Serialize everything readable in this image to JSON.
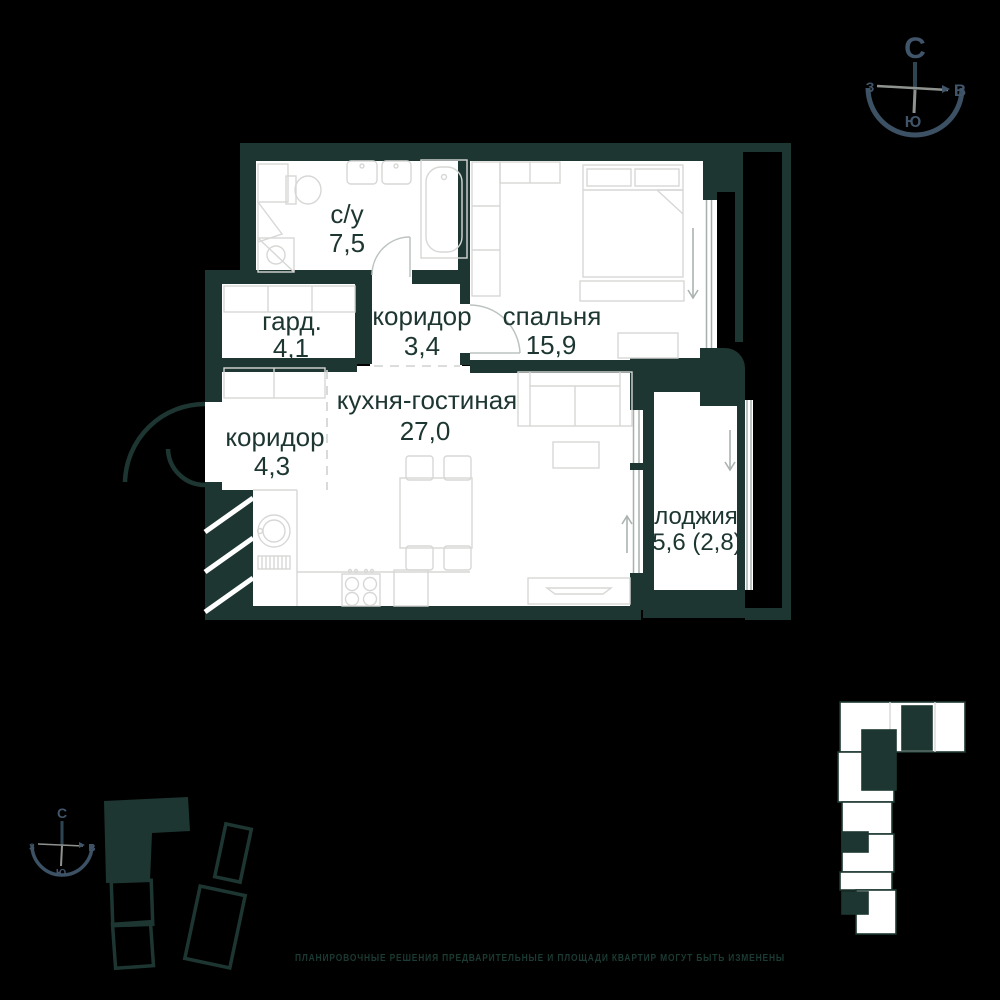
{
  "title": "apartment-floor-plan",
  "rooms": [
    {
      "name": "с/у",
      "area": "7,5"
    },
    {
      "name": "спальня",
      "area": "15,9"
    },
    {
      "name": "гард.",
      "area": "4,1"
    },
    {
      "name": "коридор",
      "area": "3,4"
    },
    {
      "name": "кухня-гостиная",
      "area": "27,0"
    },
    {
      "name": "коридор",
      "area": "4,3"
    },
    {
      "name": "лоджия",
      "area": "5,6 (2,8)"
    }
  ],
  "compass": {
    "north": "С",
    "west": "З",
    "east": "В",
    "south": "Ю"
  },
  "footer": {
    "disclaimer": "ПЛАНИРОВОЧНЫЕ РЕШЕНИЯ ПРЕДВАРИТЕЛЬНЫЕ И ПЛОЩАДИ КВАРТИР МОГУТ БЫТЬ ИЗМЕНЕНЫ"
  },
  "colors": {
    "background": "#000000",
    "wall": "#1d3631",
    "floor": "#ffffff",
    "compass": "#41556a",
    "furniture": "#d7d7d5"
  }
}
